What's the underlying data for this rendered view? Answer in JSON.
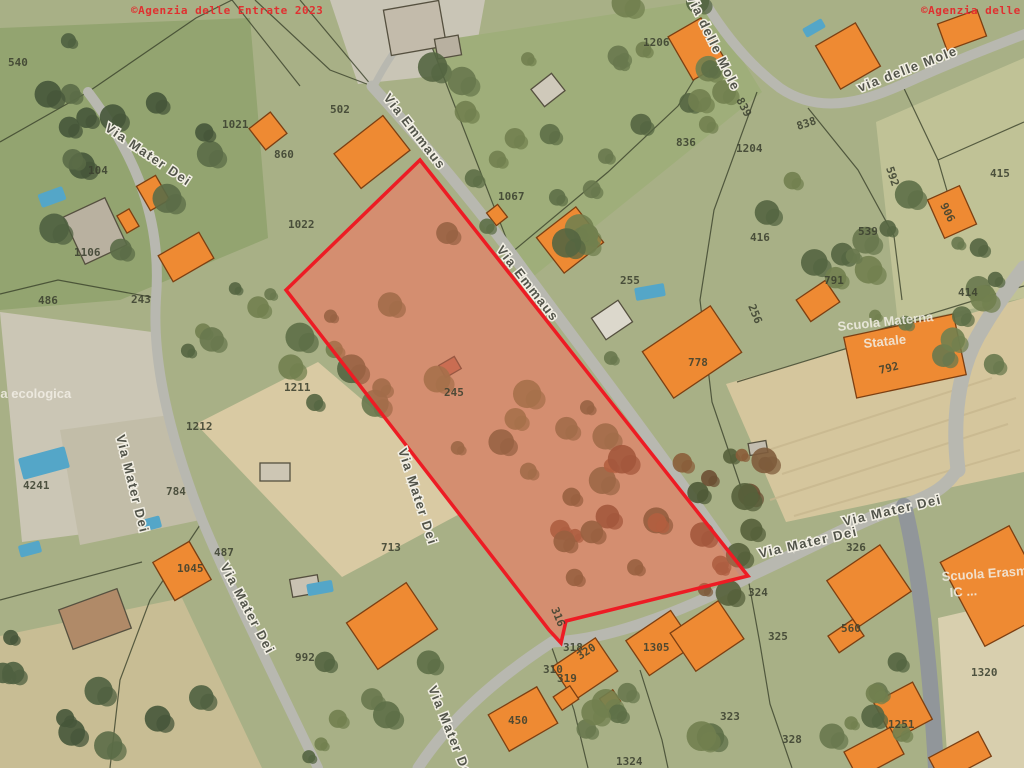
{
  "copyright": {
    "left": "©Agenzia delle Entrate 2023",
    "right": "©Agenzia delle Entrate 2023",
    "color": "#e03030"
  },
  "palette": {
    "background": "#a8b086",
    "road": "#b8b8b0",
    "road_dark": "#91969a",
    "building_fill": "#ee8a33",
    "building_stroke": "#7c3f12",
    "pool": "#54a6c8",
    "boundary": "#39412a",
    "highlight_stroke": "#ed1c24",
    "highlight_fill": "rgba(219,95,70,0.5)",
    "highlight_interior": "#cdbc9b",
    "parcel_label": "#3c4130",
    "street_label": "#52544a",
    "street_halo": "#f2efe4",
    "white_label": "#f2efe6"
  },
  "highlight": {
    "points": "420,160 748,576 566,621 561,643 549,630 286,290"
  },
  "map": {
    "parcel_labels": [
      {
        "t": "540",
        "x": 8,
        "y": 66,
        "r": 0
      },
      {
        "t": "1021",
        "x": 222,
        "y": 128,
        "r": 0
      },
      {
        "t": "502",
        "x": 330,
        "y": 113,
        "r": 0
      },
      {
        "t": "860",
        "x": 274,
        "y": 158,
        "r": 0
      },
      {
        "t": "1022",
        "x": 288,
        "y": 228,
        "r": 0
      },
      {
        "t": "1067",
        "x": 498,
        "y": 200,
        "r": 0
      },
      {
        "t": "1206",
        "x": 643,
        "y": 46,
        "r": 0
      },
      {
        "t": "836",
        "x": 676,
        "y": 146,
        "r": 0
      },
      {
        "t": "1204",
        "x": 736,
        "y": 152,
        "r": 0
      },
      {
        "t": "838",
        "x": 798,
        "y": 130,
        "r": -18
      },
      {
        "t": "839",
        "x": 736,
        "y": 100,
        "r": 62
      },
      {
        "t": "592",
        "x": 886,
        "y": 168,
        "r": 72
      },
      {
        "t": "906",
        "x": 940,
        "y": 205,
        "r": 64
      },
      {
        "t": "415",
        "x": 990,
        "y": 177,
        "r": 0
      },
      {
        "t": "539",
        "x": 858,
        "y": 235,
        "r": 0
      },
      {
        "t": "416",
        "x": 750,
        "y": 241,
        "r": 0
      },
      {
        "t": "256",
        "x": 748,
        "y": 306,
        "r": 68
      },
      {
        "t": "791",
        "x": 824,
        "y": 284,
        "r": 0
      },
      {
        "t": "255",
        "x": 620,
        "y": 284,
        "r": 0
      },
      {
        "t": "778",
        "x": 688,
        "y": 366,
        "r": 0
      },
      {
        "t": "792",
        "x": 880,
        "y": 374,
        "r": -14
      },
      {
        "t": "414",
        "x": 958,
        "y": 296,
        "r": 0
      },
      {
        "t": "245",
        "x": 444,
        "y": 396,
        "r": 0
      },
      {
        "t": "486",
        "x": 38,
        "y": 304,
        "r": 0
      },
      {
        "t": "243",
        "x": 131,
        "y": 303,
        "r": 0
      },
      {
        "t": "104",
        "x": 88,
        "y": 174,
        "r": 0
      },
      {
        "t": "1106",
        "x": 74,
        "y": 256,
        "r": 0
      },
      {
        "t": "1211",
        "x": 284,
        "y": 391,
        "r": 0
      },
      {
        "t": "1212",
        "x": 186,
        "y": 430,
        "r": 0
      },
      {
        "t": "4241",
        "x": 23,
        "y": 489,
        "r": 0
      },
      {
        "t": "784",
        "x": 166,
        "y": 495,
        "r": 0
      },
      {
        "t": "487",
        "x": 214,
        "y": 556,
        "r": 0
      },
      {
        "t": "1045",
        "x": 177,
        "y": 572,
        "r": 0
      },
      {
        "t": "713",
        "x": 381,
        "y": 551,
        "r": 0
      },
      {
        "t": "992",
        "x": 295,
        "y": 661,
        "r": 0
      },
      {
        "t": "316",
        "x": 551,
        "y": 609,
        "r": 68
      },
      {
        "t": "318",
        "x": 563,
        "y": 651,
        "r": 0
      },
      {
        "t": "320",
        "x": 580,
        "y": 660,
        "r": -33
      },
      {
        "t": "310",
        "x": 543,
        "y": 673,
        "r": 0
      },
      {
        "t": "319",
        "x": 557,
        "y": 682,
        "r": 0
      },
      {
        "t": "450",
        "x": 508,
        "y": 724,
        "r": 0
      },
      {
        "t": "1305",
        "x": 643,
        "y": 651,
        "r": 0
      },
      {
        "t": "324",
        "x": 748,
        "y": 596,
        "r": 0
      },
      {
        "t": "325",
        "x": 768,
        "y": 640,
        "r": 0
      },
      {
        "t": "328",
        "x": 782,
        "y": 743,
        "r": 0
      },
      {
        "t": "326",
        "x": 846,
        "y": 551,
        "r": 0
      },
      {
        "t": "560",
        "x": 841,
        "y": 632,
        "r": 0
      },
      {
        "t": "1320",
        "x": 971,
        "y": 676,
        "r": 0
      },
      {
        "t": "1251",
        "x": 888,
        "y": 728,
        "r": 0
      },
      {
        "t": "323",
        "x": 720,
        "y": 720,
        "r": 0
      },
      {
        "t": "1324",
        "x": 616,
        "y": 765,
        "r": 0
      }
    ],
    "street_labels": [
      {
        "t": "Via Emmaus",
        "x": 383,
        "y": 98,
        "r": 52
      },
      {
        "t": "Via Emmaus",
        "x": 496,
        "y": 250,
        "r": 52
      },
      {
        "t": "Via Mater Dei",
        "x": 104,
        "y": 130,
        "r": 34
      },
      {
        "t": "Via Mater Dei",
        "x": 116,
        "y": 436,
        "r": 76
      },
      {
        "t": "Via Mater Dei",
        "x": 220,
        "y": 566,
        "r": 62
      },
      {
        "t": "Via Mater Dei",
        "x": 398,
        "y": 450,
        "r": 72
      },
      {
        "t": "Via Mater Dei",
        "x": 760,
        "y": 558,
        "r": -13
      },
      {
        "t": "Via Mater Dei",
        "x": 844,
        "y": 526,
        "r": -13
      },
      {
        "t": "Via delle Mole",
        "x": 686,
        "y": -4,
        "r": 64
      },
      {
        "t": "via delle Mole",
        "x": 860,
        "y": 92,
        "r": -21
      },
      {
        "t": "Via Mater Dei",
        "x": 428,
        "y": 688,
        "r": 68
      }
    ],
    "area_labels": [
      {
        "t": "Isola ecologica",
        "x": -22,
        "y": 398,
        "r": 0,
        "s": 15
      },
      {
        "t": "Scuola Materna",
        "x": 838,
        "y": 331,
        "r": -6,
        "s": 13
      },
      {
        "t": "Statale",
        "x": 864,
        "y": 348,
        "r": -6,
        "s": 13
      },
      {
        "t": "Scuola Erasmo",
        "x": 942,
        "y": 581,
        "r": -4,
        "s": 13
      },
      {
        "t": "IC ...",
        "x": 950,
        "y": 597,
        "r": -4,
        "s": 13
      }
    ]
  }
}
